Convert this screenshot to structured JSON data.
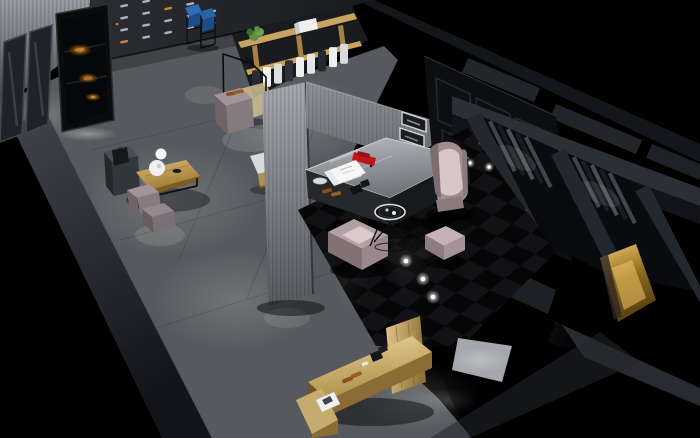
{
  "meta": {
    "type": "3d-interior-render",
    "view": "aerial-cutaway-isometric",
    "aria_label": "Aerial cutaway 3D rendering of a dark luxury boutique interior with shoe displays, clothing racks, mauve lounge seating on a glossy black checkered floor, fitting rooms and wooden counters"
  },
  "palette": {
    "bg": "#000000",
    "concrete": "#56595d",
    "concrete_light": "#9ba0a4",
    "concrete_shadow": "#202327",
    "cut_wall_top": "#3d4147",
    "cut_wall_bottom": "#14161a",
    "back_wall": "#26282d",
    "last_silver": "#adb3b8",
    "last_amber": "#c9872f",
    "left_wall": "#8f9398",
    "glass": "#1f2226",
    "glass_frame": "#41454c",
    "cabinet": "#0a0b0d",
    "amber": "#ffb14a",
    "shoe_brown": "#8a4f1c",
    "wood_shelf": "#c9a45f",
    "wood_mid": "#a8833f",
    "plant": "#5d8f43",
    "white": "#efeff0",
    "blue": "#2e6db3",
    "blue_dark": "#1b4d8c",
    "rug": "#cfc093",
    "mauve": "#a3949a",
    "mauve_light": "#dcc9cc",
    "mauve_dark": "#6f6367",
    "wood_table": "#c9a254",
    "lamp": "#f0f0f1",
    "column": "#84878c",
    "case_dark": "#26282c",
    "red": "#c0141c",
    "panel_wall": "#0d0e11",
    "panel_line": "#262b31",
    "niche": "#d4d7da",
    "wing_top": "#2b2f36",
    "wing_face": "#121419",
    "curtain_a": "#40444b",
    "curtain_b": "#1a1c21",
    "gold": "#c79a3e",
    "tile_a": "#060607",
    "tile_b": "#111116",
    "desk_front": "#8a6c34",
    "black_metal": "#0b0c0e",
    "dot": "#ffffff"
  },
  "objects": [
    "shoe-last-display-wall",
    "amber-lit-shoe-cabinet",
    "glass-partition",
    "blue-lectern-stands",
    "clothing-shelf-unit",
    "hanging-garments",
    "potted-plant",
    "white-storage-box",
    "garment-rack",
    "shoe-plinth",
    "rug",
    "side-cabinet-with-handbag",
    "wood-coffee-table",
    "white-table-lamp",
    "mauve-ottomans",
    "portal-columns",
    "glass-display-counter",
    "red-model-car",
    "display-papers",
    "display-shoes",
    "wall-shadow-boxes",
    "black-paneled-wall",
    "lit-display-niche",
    "wingback-armchair",
    "cube-armchair",
    "ottoman-cube",
    "wire-coffee-table",
    "checkered-gloss-floor",
    "ceiling-light-reflections",
    "fitting-rooms",
    "curtains",
    "gold-lit-floors",
    "wooden-cashier-desk",
    "magazine",
    "concrete-floor",
    "cutaway-walls"
  ]
}
